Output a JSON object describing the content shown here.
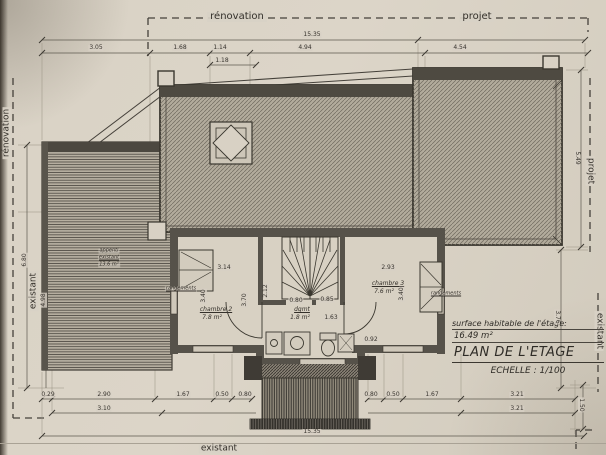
{
  "drawing": {
    "boundary_labels": {
      "top_renovation": "rénovation",
      "top_projet": "projet",
      "left_renovation": "rénovation",
      "left_existant": "existant",
      "right_projet": "projet",
      "right_existant": "existant",
      "bottom_existant": "existant"
    },
    "title_block": {
      "surface_label": "surface habitable de l'étage:",
      "surface_value": "16.49 m²",
      "title": "PLAN DE L'ETAGE",
      "scale": "ECHELLE : 1/100"
    },
    "rooms": {
      "chambre2": {
        "name": "chambre 2",
        "area": "7.8 m²"
      },
      "chambre3": {
        "name": "chambre 3",
        "area": "7.6 m²"
      },
      "dgmt": {
        "name": "dgmt",
        "area": "1.8 m²"
      },
      "appenti": {
        "line1": "appenti",
        "line2": "existant",
        "line3": "13.6 m²"
      },
      "rangements_left": "rangements",
      "rangements_right": "rangements"
    },
    "dimension_labels": [
      {
        "t": "15.35",
        "x": 312,
        "y": 35
      },
      {
        "t": "3.05",
        "x": 96,
        "y": 48
      },
      {
        "t": "1.68",
        "x": 180,
        "y": 48
      },
      {
        "t": "1.14",
        "x": 220,
        "y": 48
      },
      {
        "t": "1.18",
        "x": 222,
        "y": 61
      },
      {
        "t": "4.94",
        "x": 305,
        "y": 48
      },
      {
        "t": "4.54",
        "x": 460,
        "y": 48
      },
      {
        "t": "6.80",
        "x": 25,
        "y": 260,
        "r": -90
      },
      {
        "t": "4.98",
        "x": 44,
        "y": 300,
        "r": -90
      },
      {
        "t": "5.49",
        "x": 577,
        "y": 158,
        "r": 90
      },
      {
        "t": "3.76",
        "x": 557,
        "y": 317,
        "r": 90
      },
      {
        "t": "1.50",
        "x": 581,
        "y": 405,
        "r": 90
      },
      {
        "t": "3.14",
        "x": 224,
        "y": 268
      },
      {
        "t": "3.40",
        "x": 204,
        "y": 296,
        "r": -90
      },
      {
        "t": "3.70",
        "x": 245,
        "y": 300,
        "r": -90
      },
      {
        "t": "2.12",
        "x": 266,
        "y": 291,
        "r": -90
      },
      {
        "t": "0.80",
        "x": 296,
        "y": 301
      },
      {
        "t": "0.85",
        "x": 327,
        "y": 300
      },
      {
        "t": "1.63",
        "x": 331,
        "y": 318
      },
      {
        "t": "2.93",
        "x": 388,
        "y": 268
      },
      {
        "t": "3.40",
        "x": 402,
        "y": 294,
        "r": -90
      },
      {
        "t": "0.92",
        "x": 371,
        "y": 340
      },
      {
        "t": "0.29",
        "x": 48,
        "y": 395
      },
      {
        "t": "2.90",
        "x": 104,
        "y": 395
      },
      {
        "t": "1.67",
        "x": 183,
        "y": 395
      },
      {
        "t": "0.50",
        "x": 222,
        "y": 395
      },
      {
        "t": "0.80",
        "x": 245,
        "y": 395
      },
      {
        "t": "0.80",
        "x": 371,
        "y": 395
      },
      {
        "t": "0.50",
        "x": 393,
        "y": 395
      },
      {
        "t": "1.67",
        "x": 432,
        "y": 395
      },
      {
        "t": "3.21",
        "x": 517,
        "y": 395
      },
      {
        "t": "3.10",
        "x": 104,
        "y": 409
      },
      {
        "t": "3.21",
        "x": 517,
        "y": 409
      },
      {
        "t": "15.35",
        "x": 312,
        "y": 432
      }
    ]
  }
}
